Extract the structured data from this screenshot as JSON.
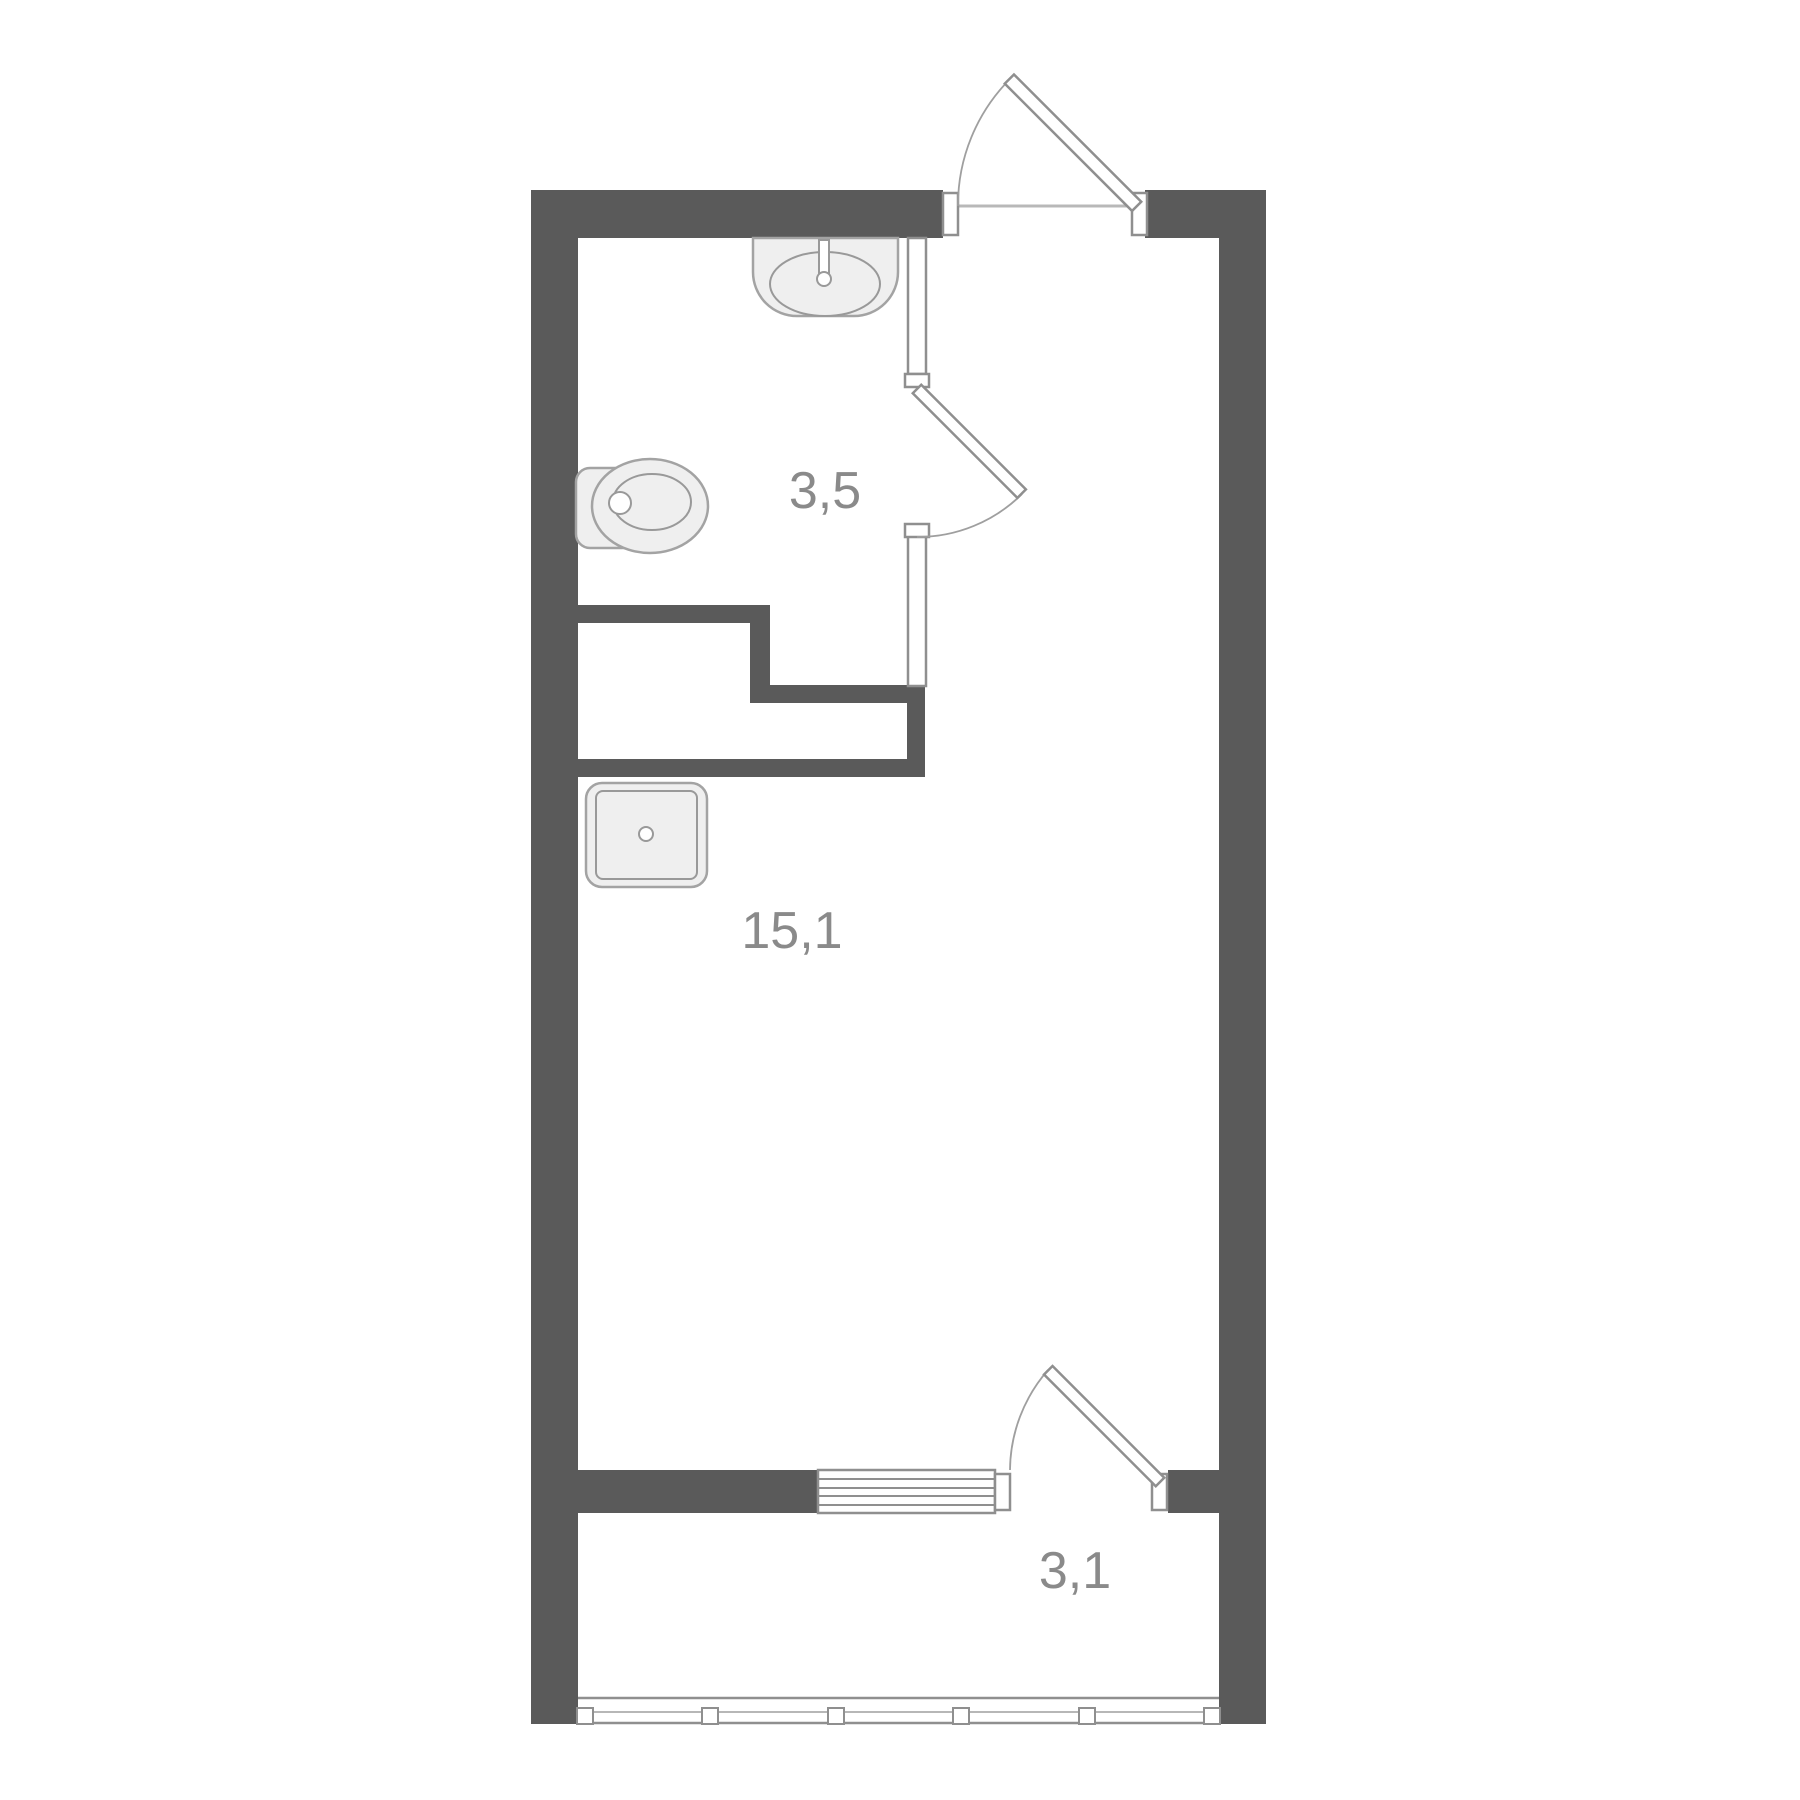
{
  "plan": {
    "type": "apartment-floor-plan",
    "rooms": [
      {
        "id": "bathroom",
        "area_label": "3,5"
      },
      {
        "id": "living-room",
        "area_label": "15,1"
      },
      {
        "id": "balcony",
        "area_label": "3,1"
      }
    ],
    "labels": {
      "bathroom_area": "3,5",
      "living_area": "15,1",
      "balcony_area": "3,1"
    },
    "fixtures": [
      "sink-icon",
      "toilet-icon",
      "shower-tray-icon",
      "radiator-icon"
    ],
    "doors": [
      "entry-door",
      "bathroom-door",
      "balcony-door"
    ],
    "window": "balcony-glazing",
    "colors": {
      "wall": "#5a5a5a",
      "thin_line": "#8f8f8f",
      "fixture_fill": "#efefef",
      "label": "#8a8a8a",
      "background": "#ffffff"
    }
  }
}
